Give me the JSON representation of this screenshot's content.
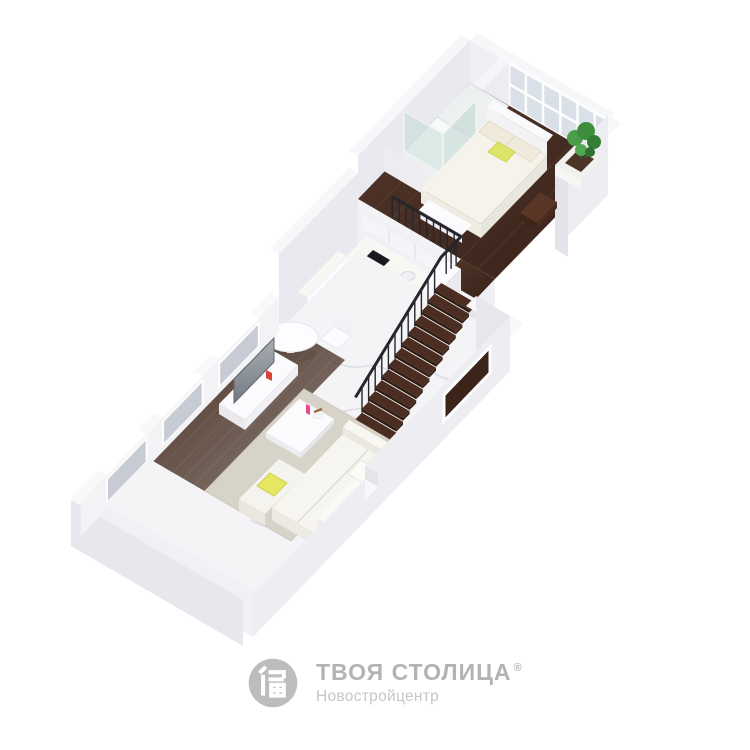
{
  "brand": {
    "title": "ТВОЯ СТОЛИЦА",
    "registered_mark": "®",
    "subtitle": "Новостройцентр",
    "icon": "building-logo-icon"
  },
  "palette": {
    "background": "#ffffff",
    "wall_white": "#f0f0f4",
    "wall_shade": "#e6e6ec",
    "wood_dark": "#462b1f",
    "marble": "#f4f4f7",
    "vein_gray": "#d9dce1",
    "railing": "#26262b",
    "stair_tread": "#4b2e21",
    "stair_riser": "#2f1d14",
    "stair_side": "#3a2418",
    "glass": "#d9e0e7",
    "glass_low": "#c7ccd4",
    "plant_green": "#3f8f3f",
    "pillow_yellow": "#e4e75f",
    "decor_pink": "#e8478b",
    "decor_red": "#d94436",
    "rug_beige": "#d8d3c8",
    "logo_text": "#b3b3b3",
    "logo_subtext": "#c6c6c6",
    "logo_icon": "#bdbdbd"
  },
  "scene": {
    "type": "isometric-3d-floor-plan",
    "levels": [
      "loft-bedroom-level",
      "ground-living-level"
    ],
    "items": [
      "double bed with beige and yellow pillows",
      "glass corner shower cabin",
      "balcony planter with green plant",
      "black metal loft railing",
      "open-riser dark wood staircase",
      "white kitchen with cooktop, oven, sink and fridge",
      "white marble floor",
      "dark hardwood floor",
      "round dining table with two chairs",
      "TV on white media console",
      "white coffee table with pink decor",
      "white corner sofa with yellow pillow",
      "glazed window wall"
    ]
  }
}
